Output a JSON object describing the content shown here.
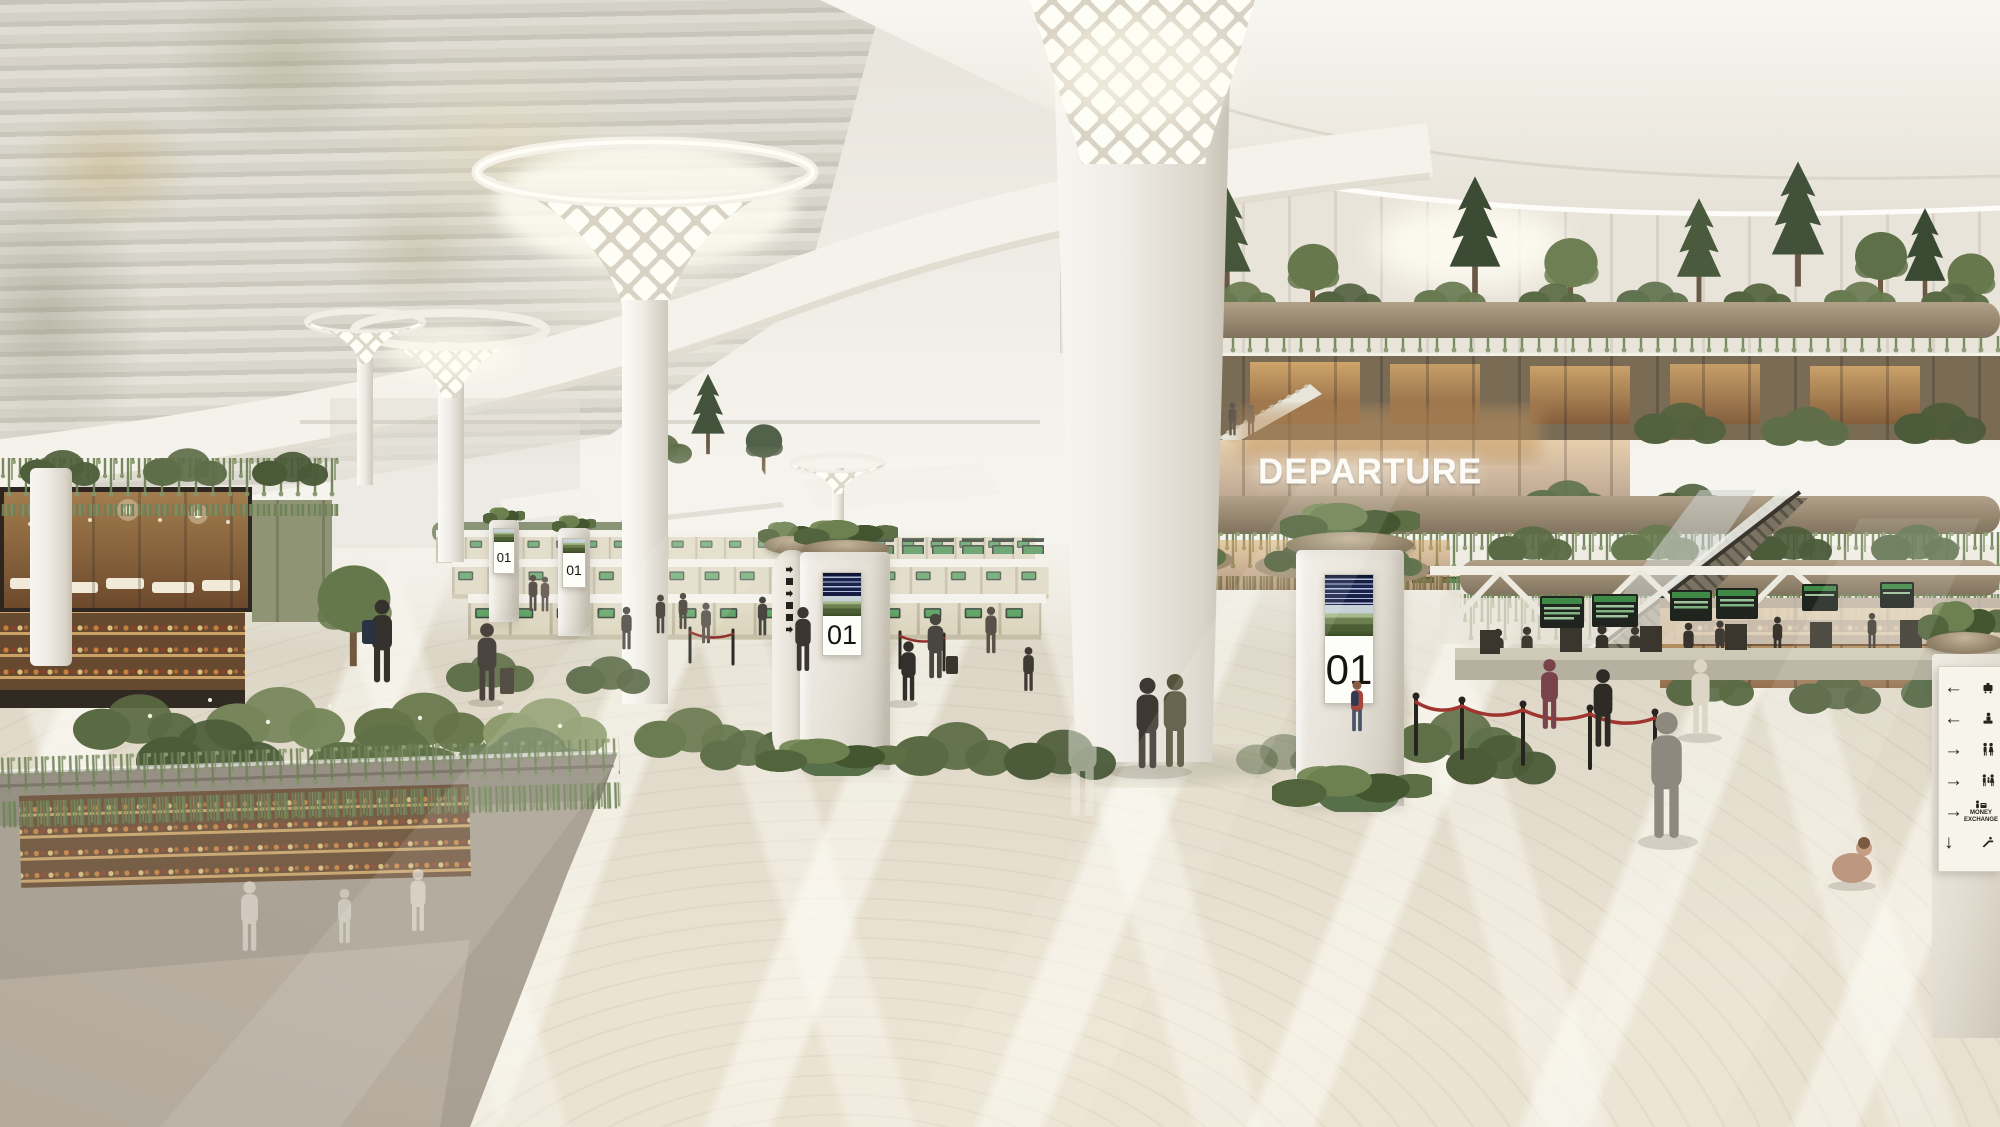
{
  "signs": {
    "departure": "DEPARTURE",
    "checkin_pillars": [
      {
        "number": "01"
      },
      {
        "number": "01"
      },
      {
        "number": "01"
      },
      {
        "number": "01"
      }
    ],
    "wayfinding": {
      "rows": [
        {
          "arrow": "←",
          "icon": "baggage-claim-icon"
        },
        {
          "arrow": "←",
          "icon": "information-desk-icon"
        },
        {
          "arrow": "→",
          "icon": "restrooms-icon"
        },
        {
          "arrow": "→",
          "icon": "family-restroom-icon"
        },
        {
          "arrow": "→",
          "icon": "money-exchange-icon",
          "label": "MONEY EXCHANGE"
        },
        {
          "arrow": "↓",
          "icon": "escalator-down-icon"
        }
      ]
    }
  },
  "colors": {
    "greenery": "#5f7048",
    "ceiling": "#f2efe9",
    "floor": "#e4ddcc",
    "wood": "#8a6a4e",
    "counter_screen_green": "#3f8a46",
    "flight_board_blue": "#1a2550",
    "signage_white": "#fcfbf7"
  }
}
